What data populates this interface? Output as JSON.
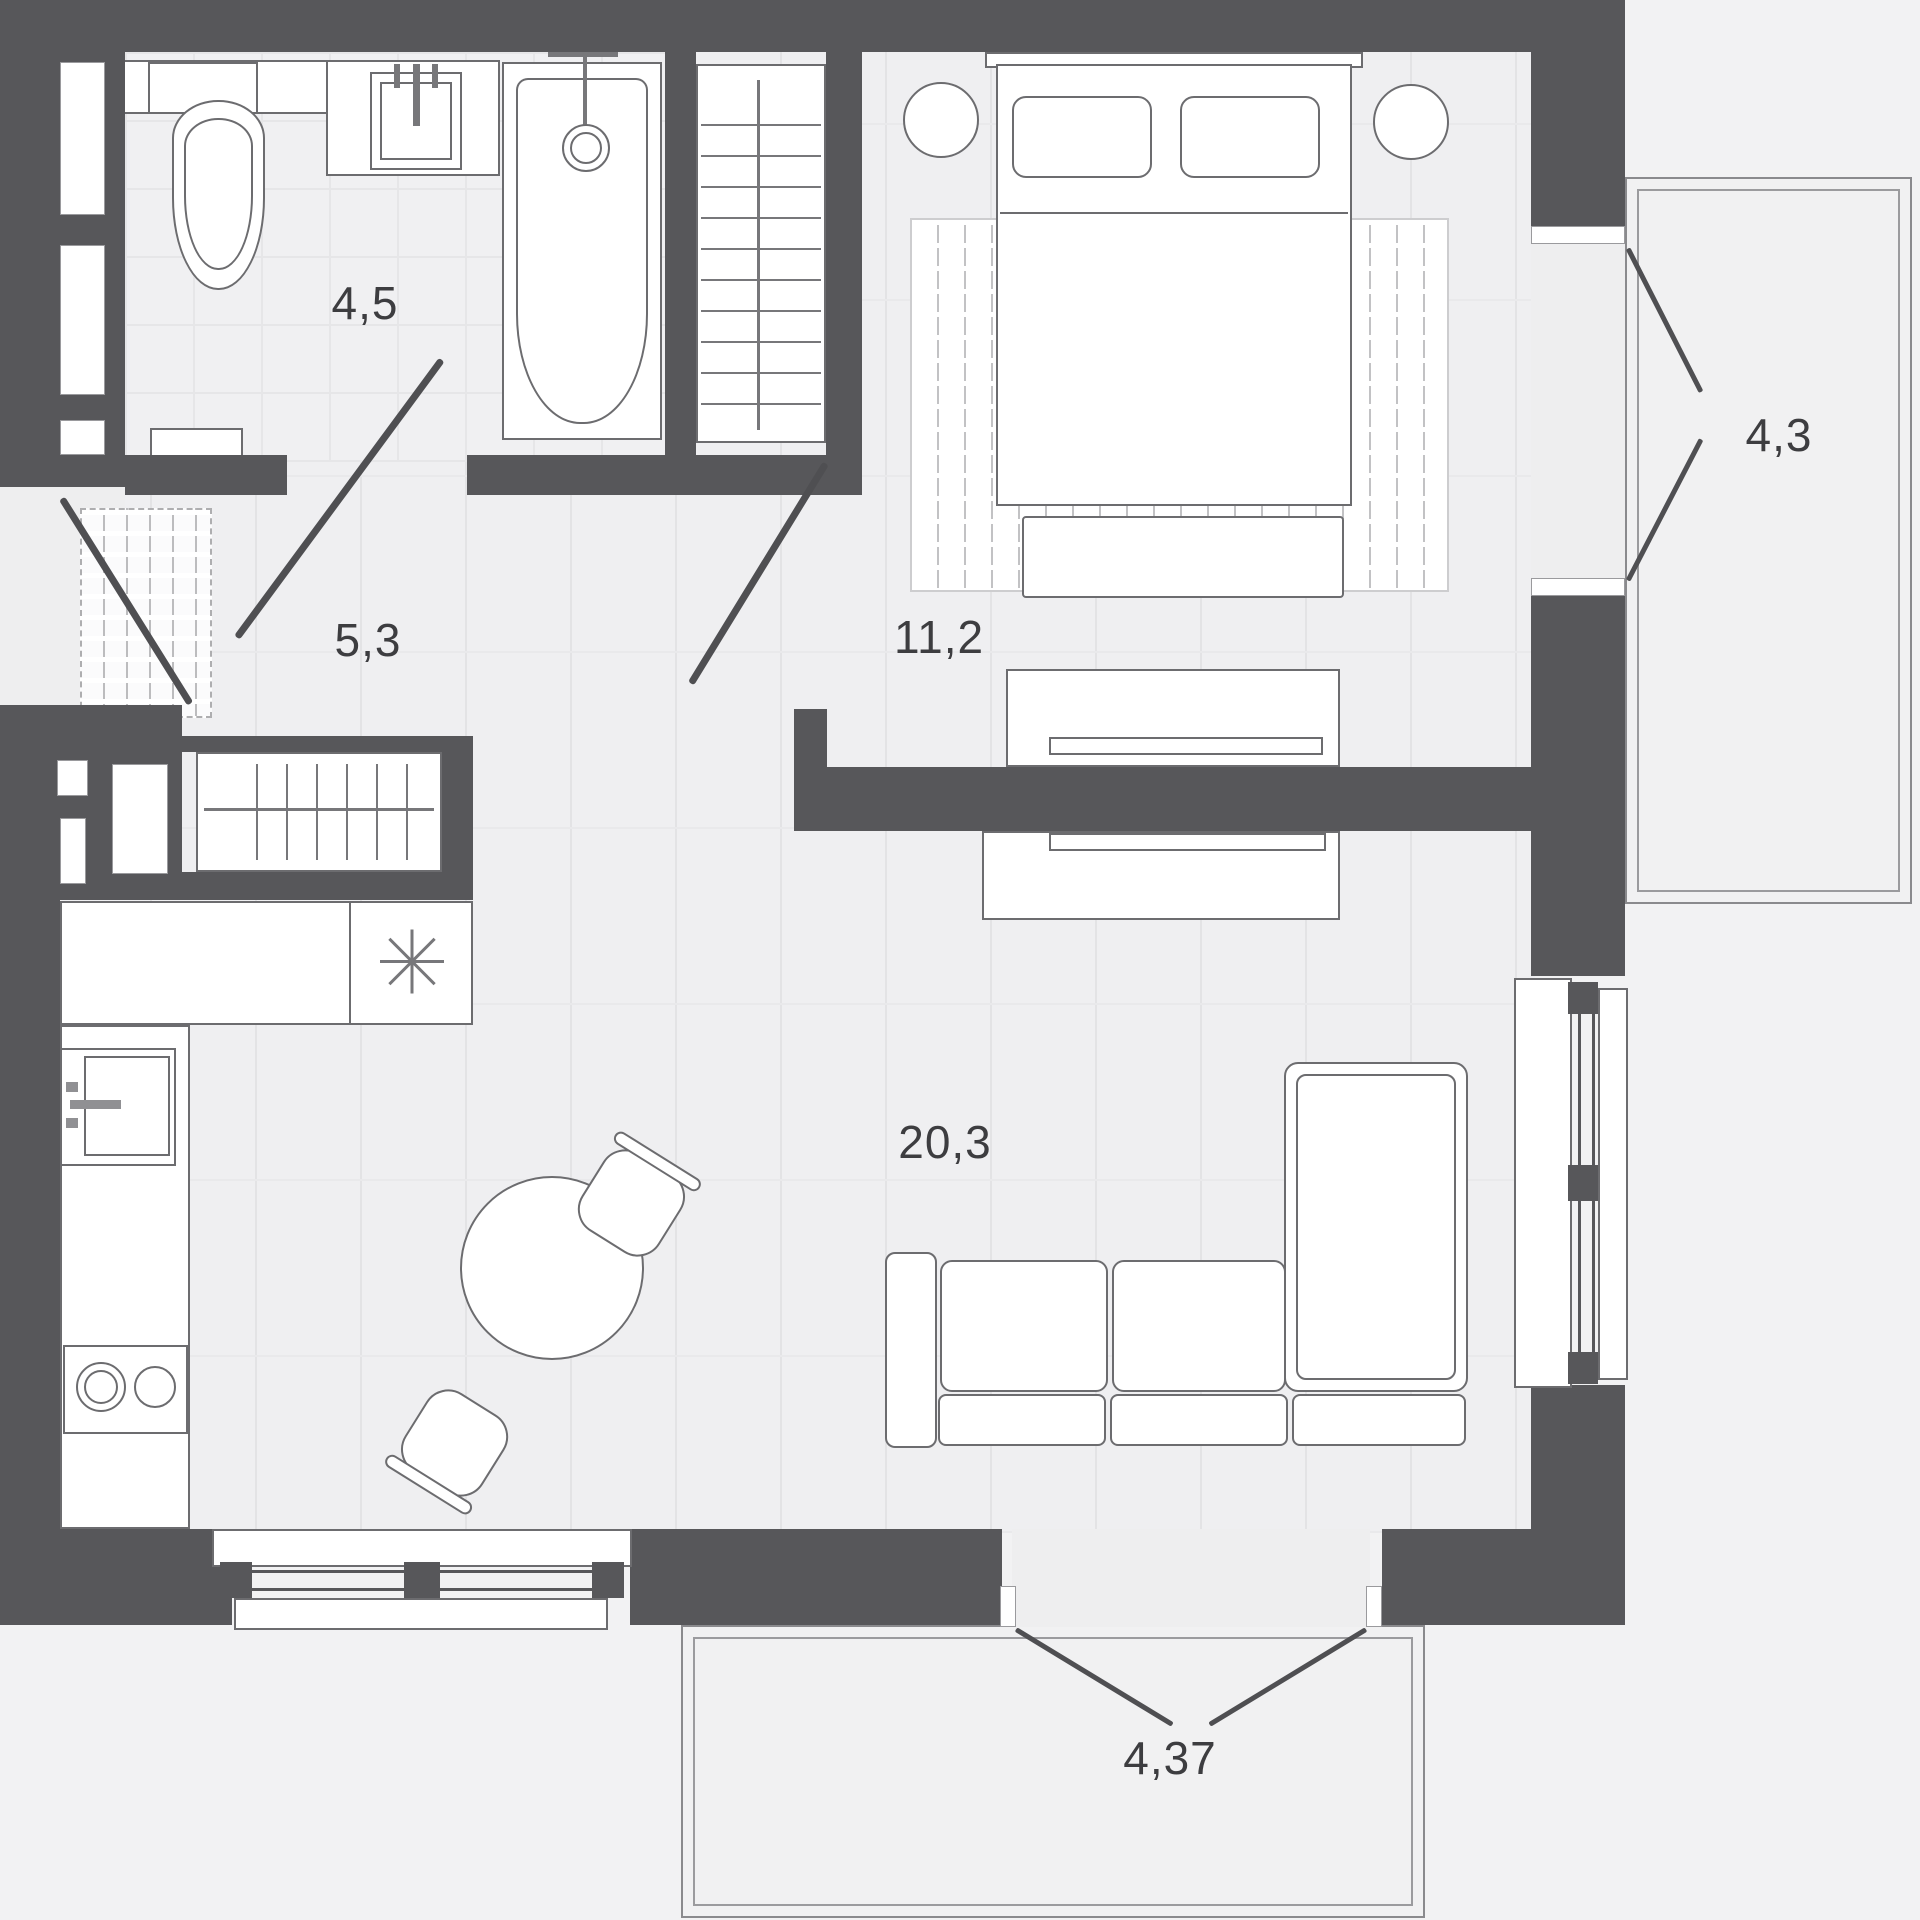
{
  "rooms": [
    {
      "id": "bathroom",
      "area": "4,5"
    },
    {
      "id": "hallway",
      "area": "5,3"
    },
    {
      "id": "bedroom",
      "area": "11,2"
    },
    {
      "id": "living-kitchen",
      "area": "20,3"
    },
    {
      "id": "balcony-right",
      "area": "4,3"
    },
    {
      "id": "balcony-bottom",
      "area": "4,37"
    }
  ],
  "colors": {
    "wall": "#57575a",
    "floor": "#efeff1",
    "outside": "#f2f2f3",
    "furniture_stroke": "#6c6c6f",
    "label": "#3d3d40"
  },
  "icons": [
    "toilet-icon",
    "bath-sink-icon",
    "bathtub-icon",
    "shower-head-icon",
    "wardrobe-hangers-icon",
    "entrance-door-swing-icon",
    "room-door-swing-icon",
    "kitchen-sink-icon",
    "hob-burners-icon",
    "cooktop-asterisk-icon",
    "dining-table-icon",
    "chair-icon",
    "sofa-icon",
    "bed-icon",
    "pillow-icon",
    "tv-icon",
    "window-icon",
    "balcony-door-swing-icon",
    "rug-icon",
    "doormat-icon"
  ]
}
